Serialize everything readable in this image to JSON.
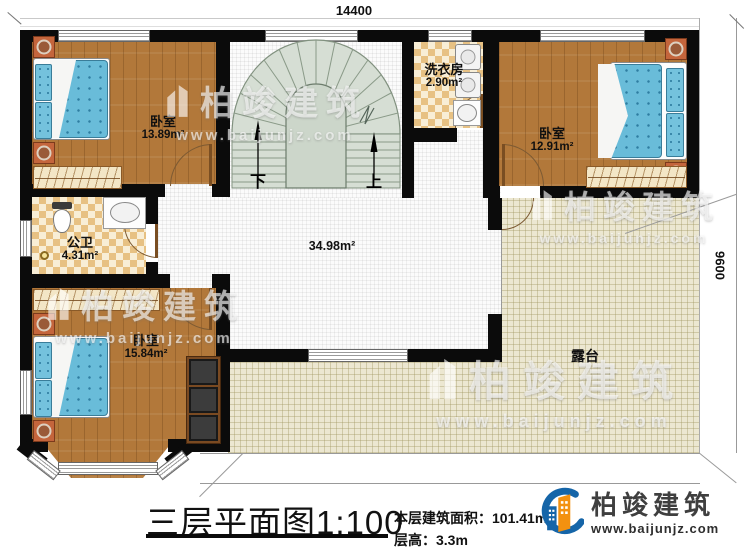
{
  "dimensions": {
    "top": "14400",
    "right": "9600"
  },
  "rooms": {
    "bedroom_tl": {
      "name": "卧室",
      "area": "13.89m²"
    },
    "bedroom_tr": {
      "name": "卧室",
      "area": "12.91m²"
    },
    "bedroom_bl": {
      "name": "卧室",
      "area": "15.84m²"
    },
    "laundry": {
      "name": "洗衣房",
      "area": "2.90m²"
    },
    "bathroom": {
      "name": "公卫",
      "area": "4.31m²"
    },
    "hall": {
      "area": "34.98m²"
    },
    "terrace": {
      "name": "露台"
    }
  },
  "stairs": {
    "down": "下",
    "up": "上"
  },
  "watermark": {
    "brand": "柏竣建筑",
    "url": "www.baijunjz.com"
  },
  "titleblock": {
    "title": "三层平面图",
    "scale": "1:100",
    "area_label": "本层建筑面积：",
    "area_value": "101.41m²",
    "height_label": "层高：",
    "height_value": "3.3m"
  },
  "logo": {
    "brand": "柏竣建筑",
    "url": "www.baijunjz.com"
  },
  "colors": {
    "wall": "#0b0b0b",
    "wood": "#b2783a",
    "tile": "#e7c183",
    "terrace": "#ece7d1",
    "stair": "#d6ded4",
    "brand_blue": "#1565a8",
    "brand_orange": "#f39110"
  }
}
